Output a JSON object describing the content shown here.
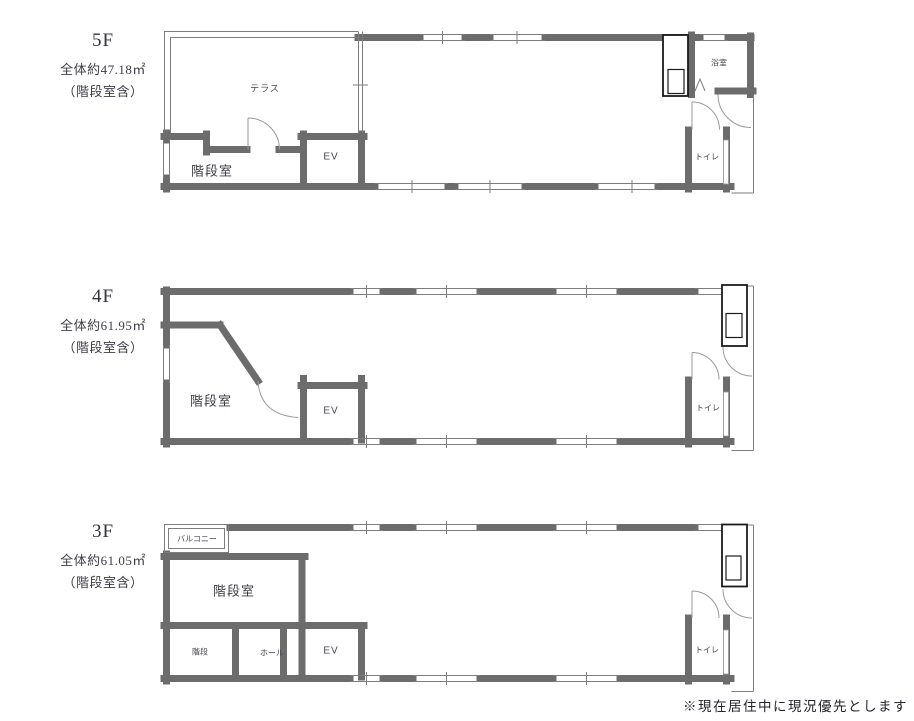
{
  "note": "※現在居住中に現況優先とします",
  "colors": {
    "wall": "#6c6c6c",
    "thin_line": "#7d7d7d",
    "door_arc": "#9a9a9a",
    "equipment_outline": "#1b1b1b",
    "text": "#3d3d46"
  },
  "floors": [
    {
      "name": "5F",
      "area": "全体約47.18㎡",
      "area_note": "（階段室含）",
      "rooms": {
        "terrace": "テラス",
        "stairwell": "階段室",
        "elevator": "EV",
        "bathroom": "浴室",
        "toilet": "トイレ"
      }
    },
    {
      "name": "4F",
      "area": "全体約61.95㎡",
      "area_note": "（階段室含）",
      "rooms": {
        "stairwell": "階段室",
        "elevator": "EV",
        "toilet": "トイレ"
      }
    },
    {
      "name": "3F",
      "area": "全体約61.05㎡",
      "area_note": "（階段室含）",
      "rooms": {
        "balcony": "バルコニー",
        "stairwell": "階段室",
        "stairs": "階段",
        "hall": "ホール",
        "elevator": "EV",
        "toilet": "トイレ"
      }
    }
  ]
}
